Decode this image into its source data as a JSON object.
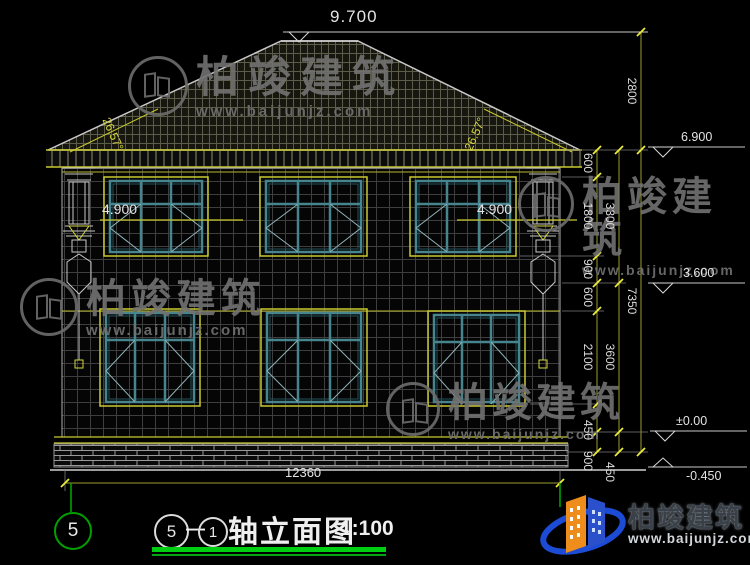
{
  "elevations": {
    "ridge": "9.700",
    "eave": "6.900",
    "floor2": "3.600",
    "ground": "±0.00",
    "below": "-0.450"
  },
  "sills": {
    "left": "4.900",
    "right": "4.900"
  },
  "angles": {
    "left": "26.57°",
    "right": "26.57°"
  },
  "dims": {
    "total_width": "12360",
    "roof_height": "2800",
    "total_height": "7350",
    "inner": [
      "600",
      "1800",
      "900",
      "600",
      "2100",
      "450",
      "900"
    ],
    "middle": [
      "3300",
      "3600",
      "450"
    ]
  },
  "axis": {
    "left_bubble": "5"
  },
  "title_block": {
    "axis_from": "5",
    "separator": "—",
    "axis_to": "1",
    "name": "轴立面图",
    "scale": "1:100"
  },
  "watermark": {
    "name": "柏竣建筑",
    "url": "www.baijunjz.com"
  },
  "brand": {
    "name": "柏竣建筑",
    "url": "www.baijunjz.com"
  }
}
